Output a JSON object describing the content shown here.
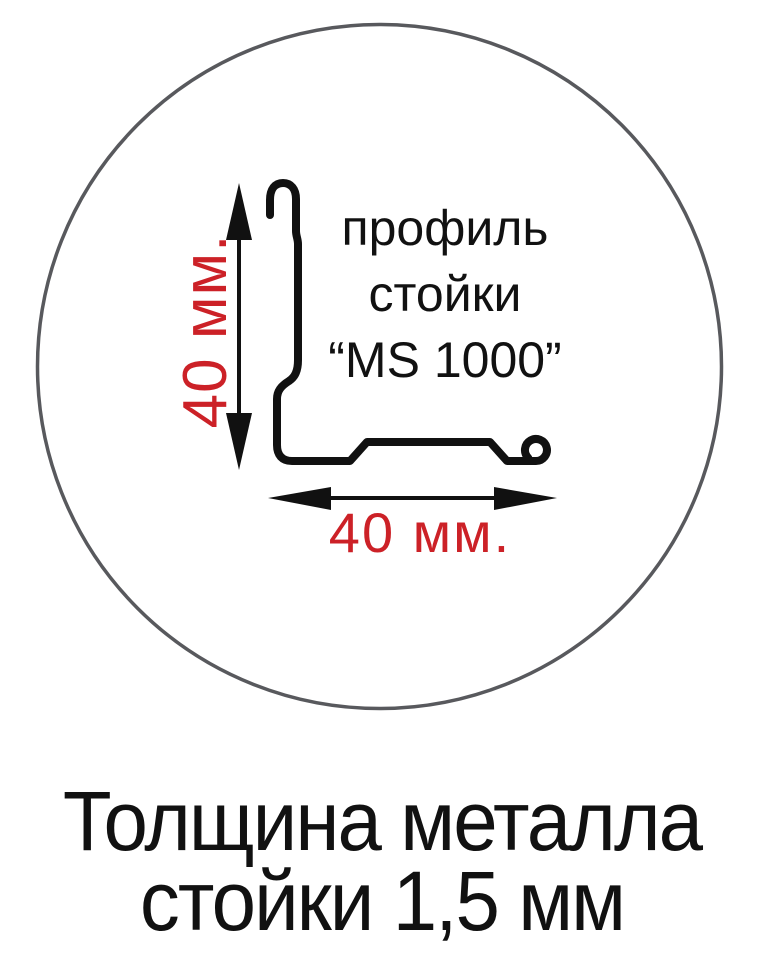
{
  "diagram": {
    "profile_label": {
      "line1": "профиль",
      "line2": "стойки",
      "line3": "“MS 1000”"
    },
    "dimensions": {
      "height_label": "40 мм.",
      "width_label": "40 мм."
    },
    "caption": {
      "line1": "Толщина металла",
      "line2": "стойки 1,5 мм"
    },
    "colors": {
      "dimension_red": "#cc2127",
      "drawing_black": "#111111",
      "circle_gray": "#58595d",
      "background": "#ffffff"
    }
  }
}
